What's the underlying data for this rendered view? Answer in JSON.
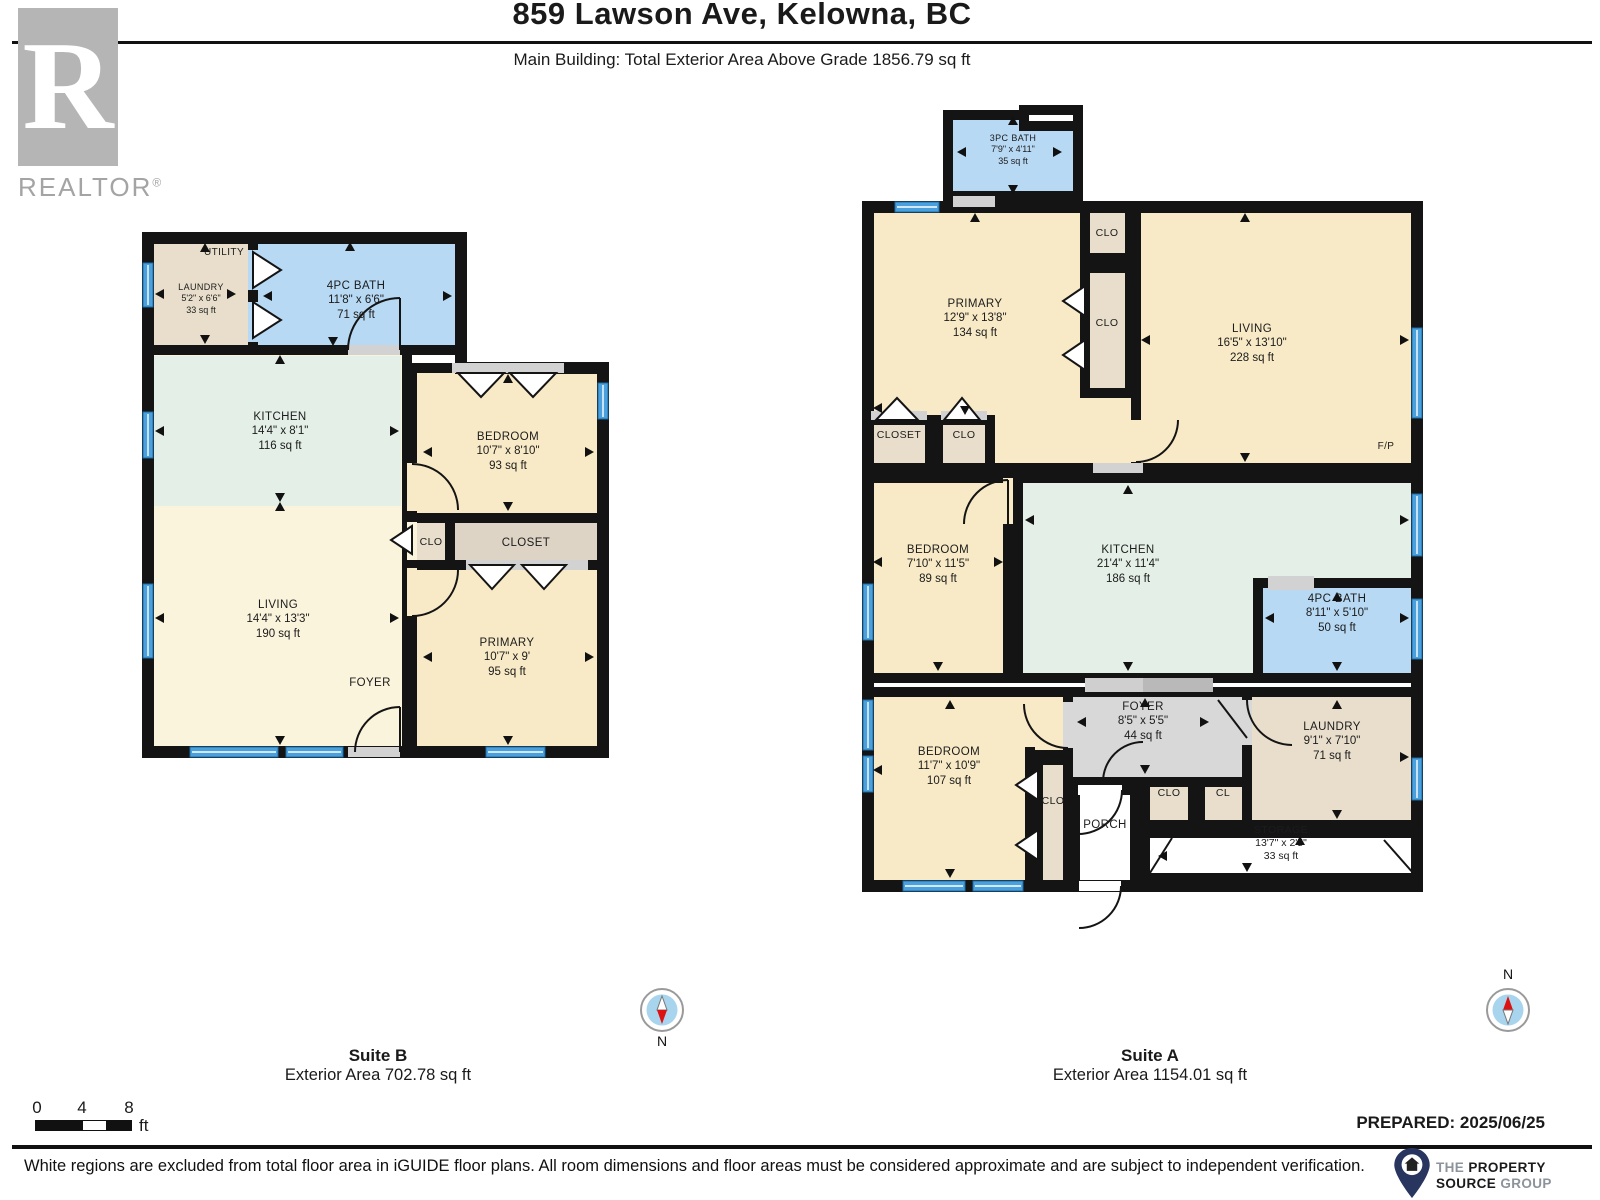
{
  "header": {
    "title": "859 Lawson Ave, Kelowna, BC",
    "subtitle": "Main Building: Total Exterior Area Above Grade 1856.79 sq ft"
  },
  "branding": {
    "realtor_letter": "R",
    "realtor_word": "REALTOR",
    "registered": "®"
  },
  "palette": {
    "wall": "#141414",
    "bath_blue": "#b7d9f4",
    "cream": "#f8eac6",
    "cream_light": "#fbf4dc",
    "mint": "#e4efe7",
    "tan": "#e8decb",
    "closet_gray": "#ddd4c5",
    "foyer_gray": "#d8d8d8",
    "threshold": "#d2d2d2",
    "window_blue": "#4aa0dc",
    "window_edge": "#1d6ca6"
  },
  "plans": [
    {
      "id": "suite_b",
      "name": "Suite B",
      "area_label": "Exterior Area 702.78 sq ft",
      "rooms": {
        "utility": {
          "name": "UTILITY"
        },
        "laundry": {
          "name": "LAUNDRY",
          "dims": "5'2\" x 6'6\"",
          "area": "33 sq ft"
        },
        "bath": {
          "name": "4PC BATH",
          "dims": "11'8\" x 6'6\"",
          "area": "71 sq ft"
        },
        "kitchen": {
          "name": "KITCHEN",
          "dims": "14'4\" x 8'1\"",
          "area": "116 sq ft"
        },
        "bedroom": {
          "name": "BEDROOM",
          "dims": "10'7\" x 8'10\"",
          "area": "93 sq ft"
        },
        "clo": {
          "name": "CLO"
        },
        "closet": {
          "name": "CLOSET"
        },
        "living": {
          "name": "LIVING",
          "dims": "14'4\" x 13'3\"",
          "area": "190 sq ft"
        },
        "foyer": {
          "name": "FOYER"
        },
        "primary": {
          "name": "PRIMARY",
          "dims": "10'7\" x 9'",
          "area": "95 sq ft"
        }
      }
    },
    {
      "id": "suite_a",
      "name": "Suite A",
      "area_label": "Exterior Area 1154.01 sq ft",
      "rooms": {
        "bath3": {
          "name": "3PC BATH",
          "dims": "7'9\" x 4'11\"",
          "area": "35 sq ft"
        },
        "primary": {
          "name": "PRIMARY",
          "dims": "12'9\" x 13'8\"",
          "area": "134 sq ft"
        },
        "clo_top": {
          "name": "CLO"
        },
        "clo_mid": {
          "name": "CLO"
        },
        "living": {
          "name": "LIVING",
          "dims": "16'5\" x 13'10\"",
          "area": "228 sq ft"
        },
        "fp": {
          "name": "F/P"
        },
        "closet": {
          "name": "CLOSET"
        },
        "clo2": {
          "name": "CLO"
        },
        "bedroom_mid": {
          "name": "BEDROOM",
          "dims": "7'10\" x 11'5\"",
          "area": "89 sq ft"
        },
        "kitchen": {
          "name": "KITCHEN",
          "dims": "21'4\" x 11'4\"",
          "area": "186 sq ft"
        },
        "bath4": {
          "name": "4PC BATH",
          "dims": "8'11\" x 5'10\"",
          "area": "50 sq ft"
        },
        "bedroom_bot": {
          "name": "BEDROOM",
          "dims": "11'7\" x 10'9\"",
          "area": "107 sq ft"
        },
        "clo_strip": {
          "name": "CLO"
        },
        "foyer": {
          "name": "FOYER",
          "dims": "8'5\" x 5'5\"",
          "area": "44 sq ft"
        },
        "laundry": {
          "name": "LAUNDRY",
          "dims": "9'1\" x 7'10\"",
          "area": "71 sq ft"
        },
        "clo_small": {
          "name": "CLO"
        },
        "cl": {
          "name": "CL"
        },
        "porch": {
          "name": "PORCH"
        },
        "storage": {
          "name": "STORAGE",
          "dims": "13'7\" x 2'5\"",
          "area": "33 sq ft"
        }
      }
    }
  ],
  "compass": {
    "north_label": "N"
  },
  "scale_bar": {
    "ticks": [
      "0",
      "4",
      "8"
    ],
    "unit": "ft"
  },
  "footer": {
    "prepared": "PREPARED: 2025/06/25",
    "disclaimer": "White regions are excluded from total floor area in iGUIDE floor plans. All room dimensions and floor areas must be considered approximate and are subject to independent verification.",
    "logo": {
      "line1_light": "THE",
      "line1_bold": "PROPERTY",
      "line2_bold": "SOURCE",
      "line2_light": "GROUP"
    }
  }
}
